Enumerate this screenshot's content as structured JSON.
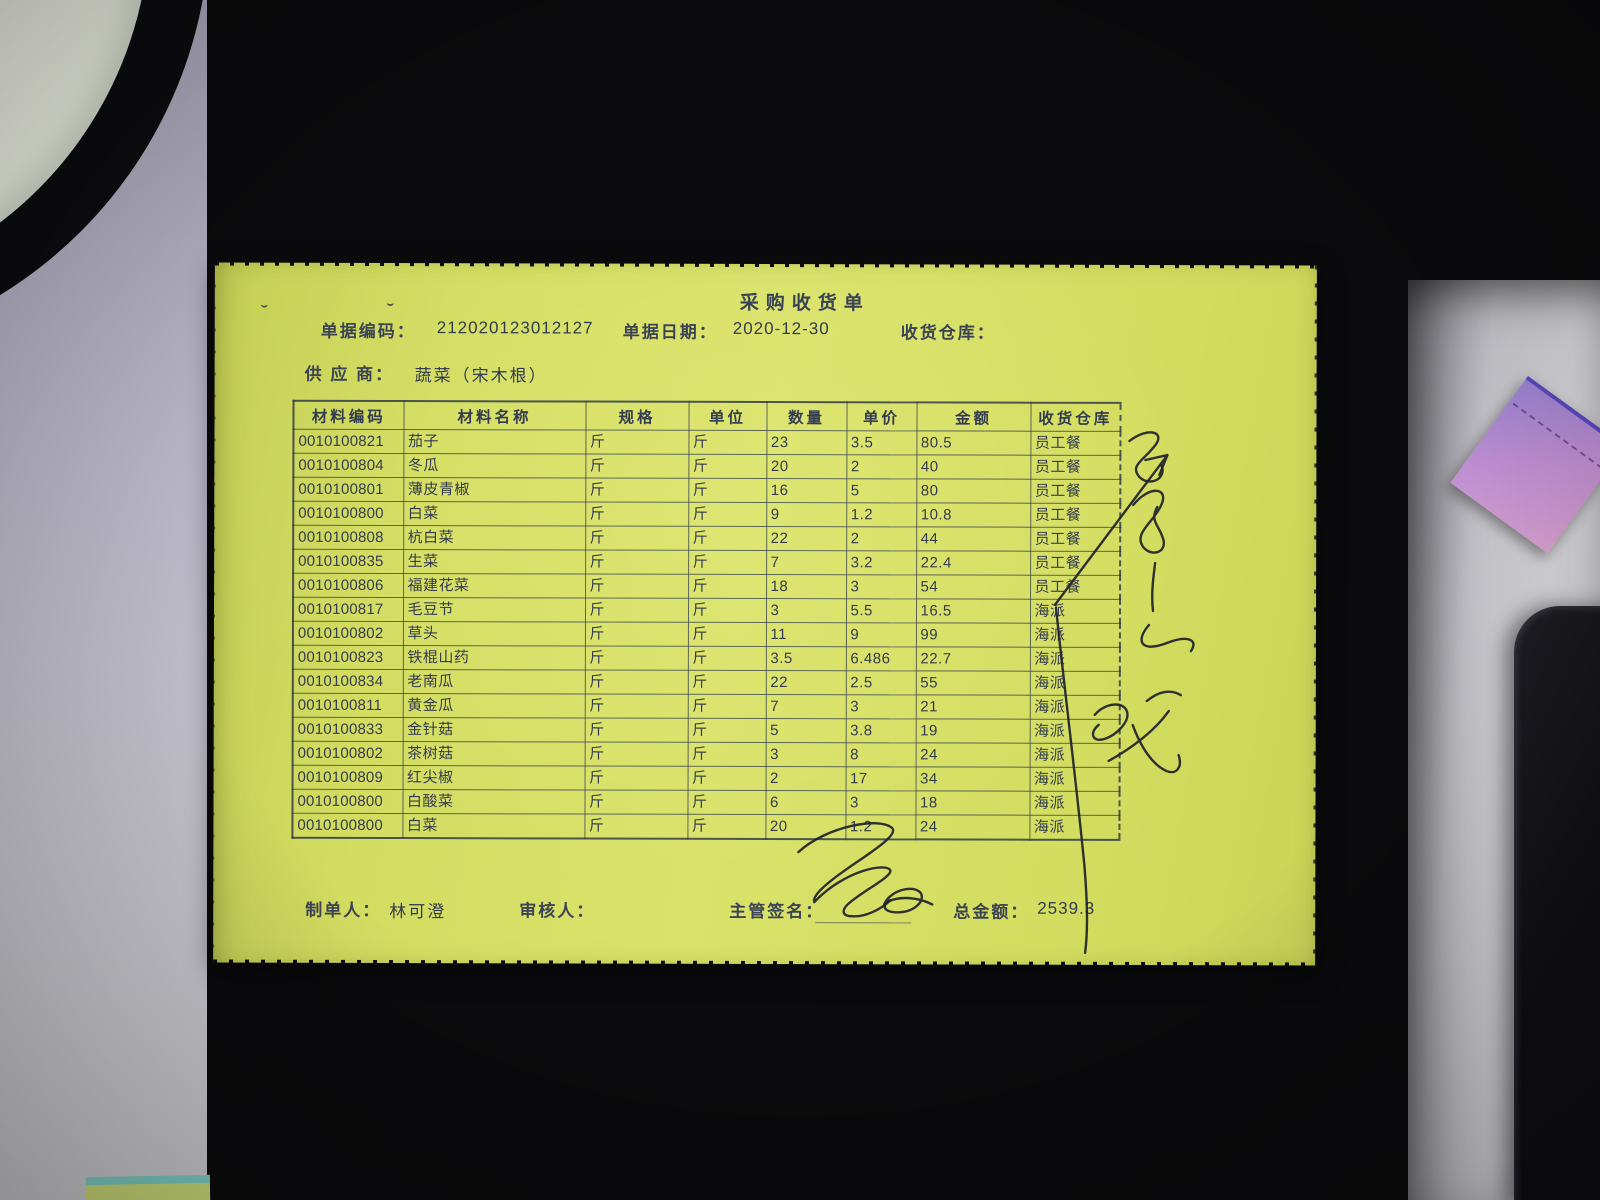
{
  "document": {
    "title": "采购收货单",
    "fields": {
      "code_label": "单据编码：",
      "code_value": "212020123012127",
      "date_label": "单据日期：",
      "date_value": "2020-12-30",
      "warehouse_label": "收货仓库：",
      "warehouse_value": "",
      "supplier_label": "供 应 商：",
      "supplier_value": "蔬菜（宋木根）"
    },
    "table": {
      "headers": [
        "材料编码",
        "材料名称",
        "规格",
        "单位",
        "数量",
        "单价",
        "金额",
        "收货仓库"
      ],
      "rows": [
        [
          "0010100821",
          "茄子",
          "",
          "斤",
          "23",
          "3.5",
          "80.5",
          "员工餐"
        ],
        [
          "0010100804",
          "冬瓜",
          "",
          "斤",
          "20",
          "2",
          "40",
          "员工餐"
        ],
        [
          "0010100801",
          "薄皮青椒",
          "",
          "斤",
          "16",
          "5",
          "80",
          "员工餐"
        ],
        [
          "0010100800",
          "白菜",
          "",
          "斤",
          "9",
          "1.2",
          "10.8",
          "员工餐"
        ],
        [
          "0010100808",
          "杭白菜",
          "",
          "斤",
          "22",
          "2",
          "44",
          "员工餐"
        ],
        [
          "0010100835",
          "生菜",
          "",
          "斤",
          "7",
          "3.2",
          "22.4",
          "员工餐"
        ],
        [
          "0010100806",
          "福建花菜",
          "",
          "斤",
          "18",
          "3",
          "54",
          "员工餐"
        ],
        [
          "0010100817",
          "毛豆节",
          "",
          "斤",
          "3",
          "5.5",
          "16.5",
          "海派"
        ],
        [
          "0010100802",
          "草头",
          "",
          "斤",
          "11",
          "9",
          "99",
          "海派"
        ],
        [
          "0010100823",
          "铁棍山药",
          "",
          "斤",
          "3.5",
          "6.486",
          "22.7",
          "海派"
        ],
        [
          "0010100834",
          "老南瓜",
          "",
          "斤",
          "22",
          "2.5",
          "55",
          "海派"
        ],
        [
          "0010100811",
          "黄金瓜",
          "",
          "斤",
          "7",
          "3",
          "21",
          "海派"
        ],
        [
          "0010100833",
          "金针菇",
          "",
          "斤",
          "5",
          "3.8",
          "19",
          "海派"
        ],
        [
          "0010100802",
          "茶树菇",
          "",
          "斤",
          "3",
          "8",
          "24",
          "海派"
        ],
        [
          "0010100809",
          "红尖椒",
          "",
          "斤",
          "2",
          "17",
          "34",
          "海派"
        ],
        [
          "0010100800",
          "白酸菜",
          "",
          "斤",
          "6",
          "3",
          "18",
          "海派"
        ],
        [
          "0010100800",
          "白菜",
          "",
          "斤",
          "20",
          "1.2",
          "24",
          "海派"
        ]
      ],
      "spec_cell_value": "斤"
    },
    "footer": {
      "maker_label": "制单人：",
      "maker_value": "林可澄",
      "auditor_label": "审核人：",
      "signer_label": "主管签名：",
      "total_label": "总金额：",
      "total_value": "2539.3"
    }
  },
  "handwriting": {
    "marks": [
      "vertical-cursive-scribble",
      "arrow-stroke",
      "long-curve-stroke",
      "cursive-mark",
      "supervisor-signature"
    ]
  },
  "colors": {
    "paper": "#d5df63",
    "print": "#39414f",
    "mat": "#0b0b0d",
    "desk_left": "#b4b1c2",
    "desk_right": "#d6d6da",
    "purple_note": "#c291d8",
    "teal_note": "#7fd2c8",
    "ink": "#1f222b"
  }
}
